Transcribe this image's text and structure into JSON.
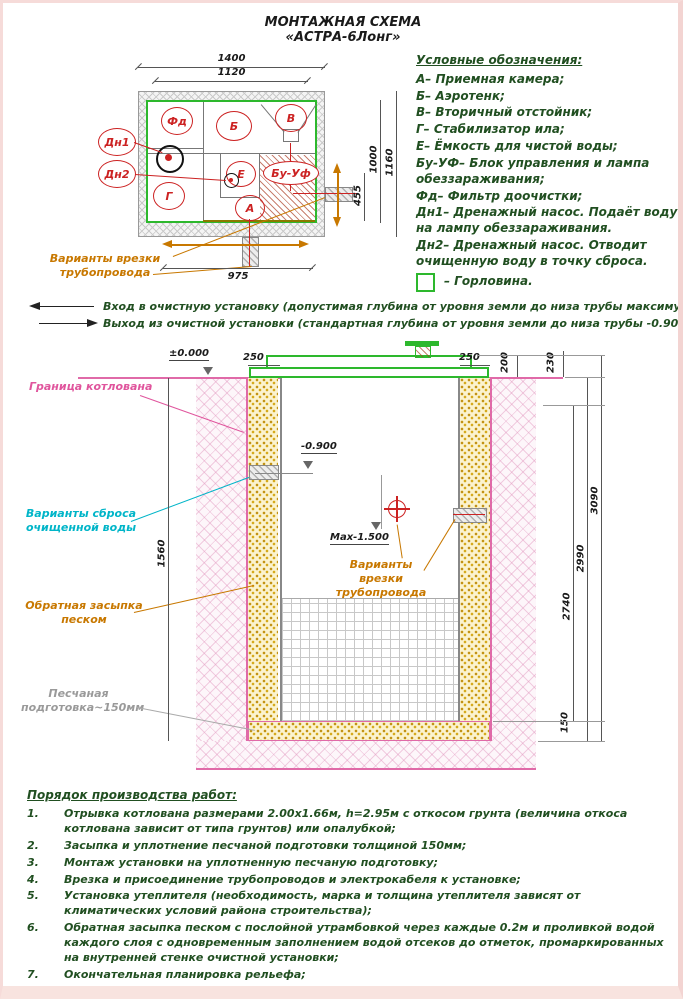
{
  "title": {
    "line1": "МОНТАЖНАЯ СХЕМА",
    "line2": "«АСТРА-6Лонг»"
  },
  "plan": {
    "compartments": {
      "fd": "Фд",
      "b": "Б",
      "v": "В",
      "g": "Г",
      "e": "Е",
      "a": "А",
      "buuf": "Бу-Уф",
      "dn1": "Дн1",
      "dn2": "Дн2"
    },
    "dims": {
      "w_outer": "1400",
      "w_inner": "1120",
      "h_inner": "1000",
      "h_outer": "1160",
      "outlet_offset": "455",
      "inlet_span": "975"
    },
    "callout": "Варианты врезки трубопровода"
  },
  "legend": {
    "title": "Условные обозначения:",
    "items": [
      "А– Приемная камера;",
      "Б– Аэротенк;",
      "В– Вторичный отстойник;",
      "Г– Стабилизатор ила;",
      "Е– Ёмкость для чистой воды;",
      "Бу-УФ– Блок управления и лампа обеззараживания;",
      "Фд– Фильтр доочистки;",
      "Дн1– Дренажный насос. Подаёт воду на лампу обеззараживания.",
      "Дн2– Дренажный насос. Отводит очищенную воду в точку сброса."
    ],
    "gorlovina": "– Горловина."
  },
  "io_notes": {
    "inlet": "Вход в очистную установку (допустимая глубина от уровня земли до низа трубы максимум -1.500)",
    "outlet": "Выход из очистной установки (стандартная глубина от уровня земли до низа трубы -0.900)"
  },
  "section": {
    "levels": {
      "ground": "±0.000",
      "outlet": "-0.900",
      "inlet_max": "Max-1.500"
    },
    "dims": {
      "left_backfill": "250",
      "right_backfill": "250",
      "lid_side": "200",
      "lid_top": "230",
      "tank_body": "2740",
      "tank_total": "2990",
      "overall": "3090",
      "sand_bed": "150",
      "pit_left": "1560"
    },
    "labels": {
      "pit_boundary": "Граница котлована",
      "discharge": "Варианты сброса очищенной воды",
      "backfill": "Обратная засыпка песком",
      "sand_bed": "Песчаная подготовка~150мм",
      "pipe_inlet": "Варианты врезки трубопровода"
    }
  },
  "work_order": {
    "title": "Порядок производства работ:",
    "items": [
      {
        "num": "1.",
        "text": "Отрывка котлована размерами 2.00х1.66м, h=2.95м с откосом грунта (величина откоса котлована зависит от типа грунтов) или опалубкой;"
      },
      {
        "num": "2.",
        "text": "Засыпка и уплотнение песчаной подготовки толщиной 150мм;"
      },
      {
        "num": "3.",
        "text": "Монтаж установки на уплотненную песчаную подготовку;"
      },
      {
        "num": "4.",
        "text": "Врезка и присоединение трубопроводов и электрокабеля к установке;"
      },
      {
        "num": "5.",
        "text": "Установка утеплителя (необходимость, марка и толщина утеплителя зависят от климатических условий района строительства);"
      },
      {
        "num": "6.",
        "text": "Обратная засыпка песком с послойной утрамбовкой через каждые 0.2м и проливкой водой каждого слоя с одновременным заполнением водой отсеков до отметок, промаркированных на внутренней стенке очистной установки;"
      },
      {
        "num": "7.",
        "text": "Окончательная планировка рельефа;"
      },
      {
        "num": "8.",
        "text": "Запуск очистной установки в эксплуатацию."
      }
    ]
  },
  "colors": {
    "green": "#2db82d",
    "red": "#cc2222",
    "magenta": "#e0559d",
    "cyan": "#00b5c8",
    "orange": "#c87800",
    "text": "#214f21",
    "sand": "#c09010"
  }
}
